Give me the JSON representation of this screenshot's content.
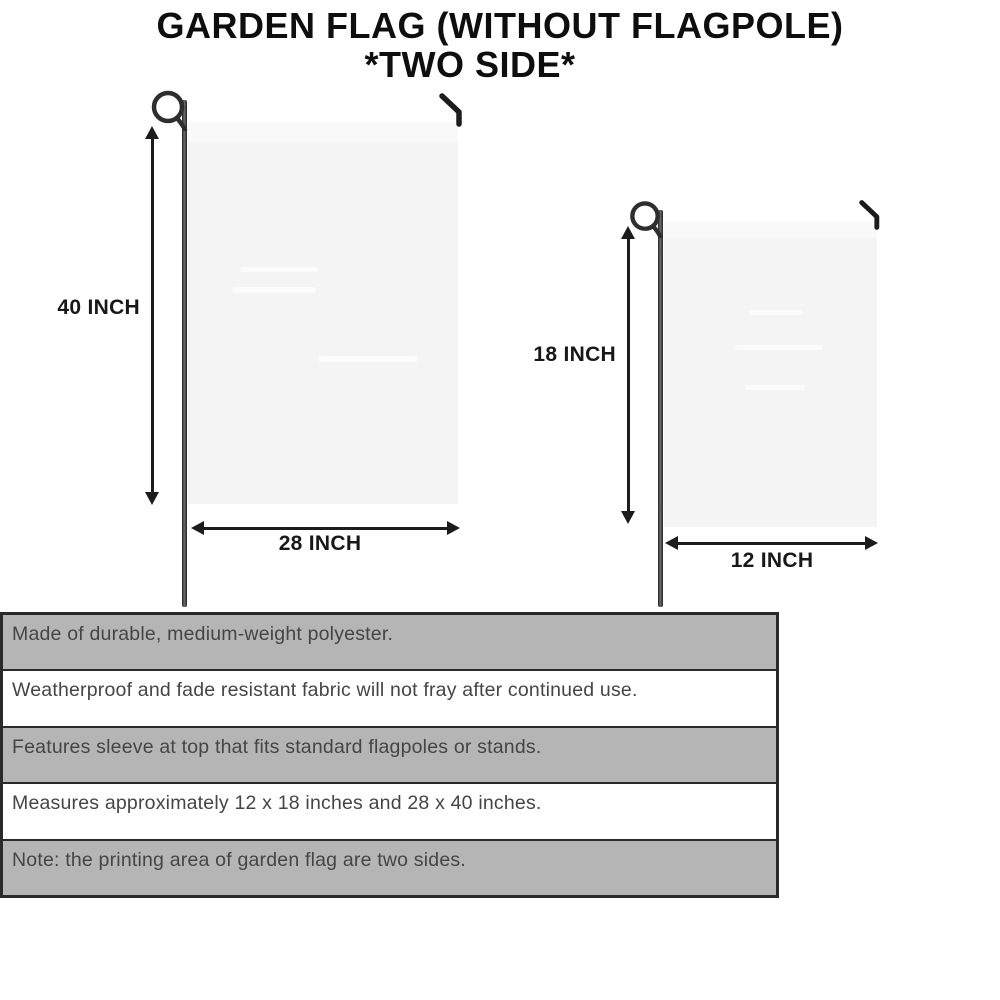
{
  "title": {
    "line1": "GARDEN FLAG (WITHOUT FLAGPOLE)",
    "line2": "*TWO SIDE*"
  },
  "flags": {
    "large": {
      "height_label": "40 INCH",
      "width_label": "28 INCH"
    },
    "small": {
      "height_label": "18 INCH",
      "width_label": "12 INCH"
    }
  },
  "features": [
    "Made of durable, medium-weight polyester.",
    "Weatherproof and fade resistant fabric will not fray after continued use.",
    "Features sleeve at top that fits standard flagpoles or stands.",
    "Measures approximately 12 x 18 inches and 28 x 40 inches.",
    "Note: the printing area of garden flag are two sides."
  ],
  "colors": {
    "row_gray": "#b5b5b5",
    "row_white": "#ffffff",
    "table_border": "#2a2a2a",
    "table_text": "#454545",
    "arrow": "#1c1c1c",
    "pole": "#2e2e2e",
    "flag_fill": "#f4f4f4",
    "flag_sleeve": "#f9f9f9",
    "title_text": "#0e0e0e"
  }
}
